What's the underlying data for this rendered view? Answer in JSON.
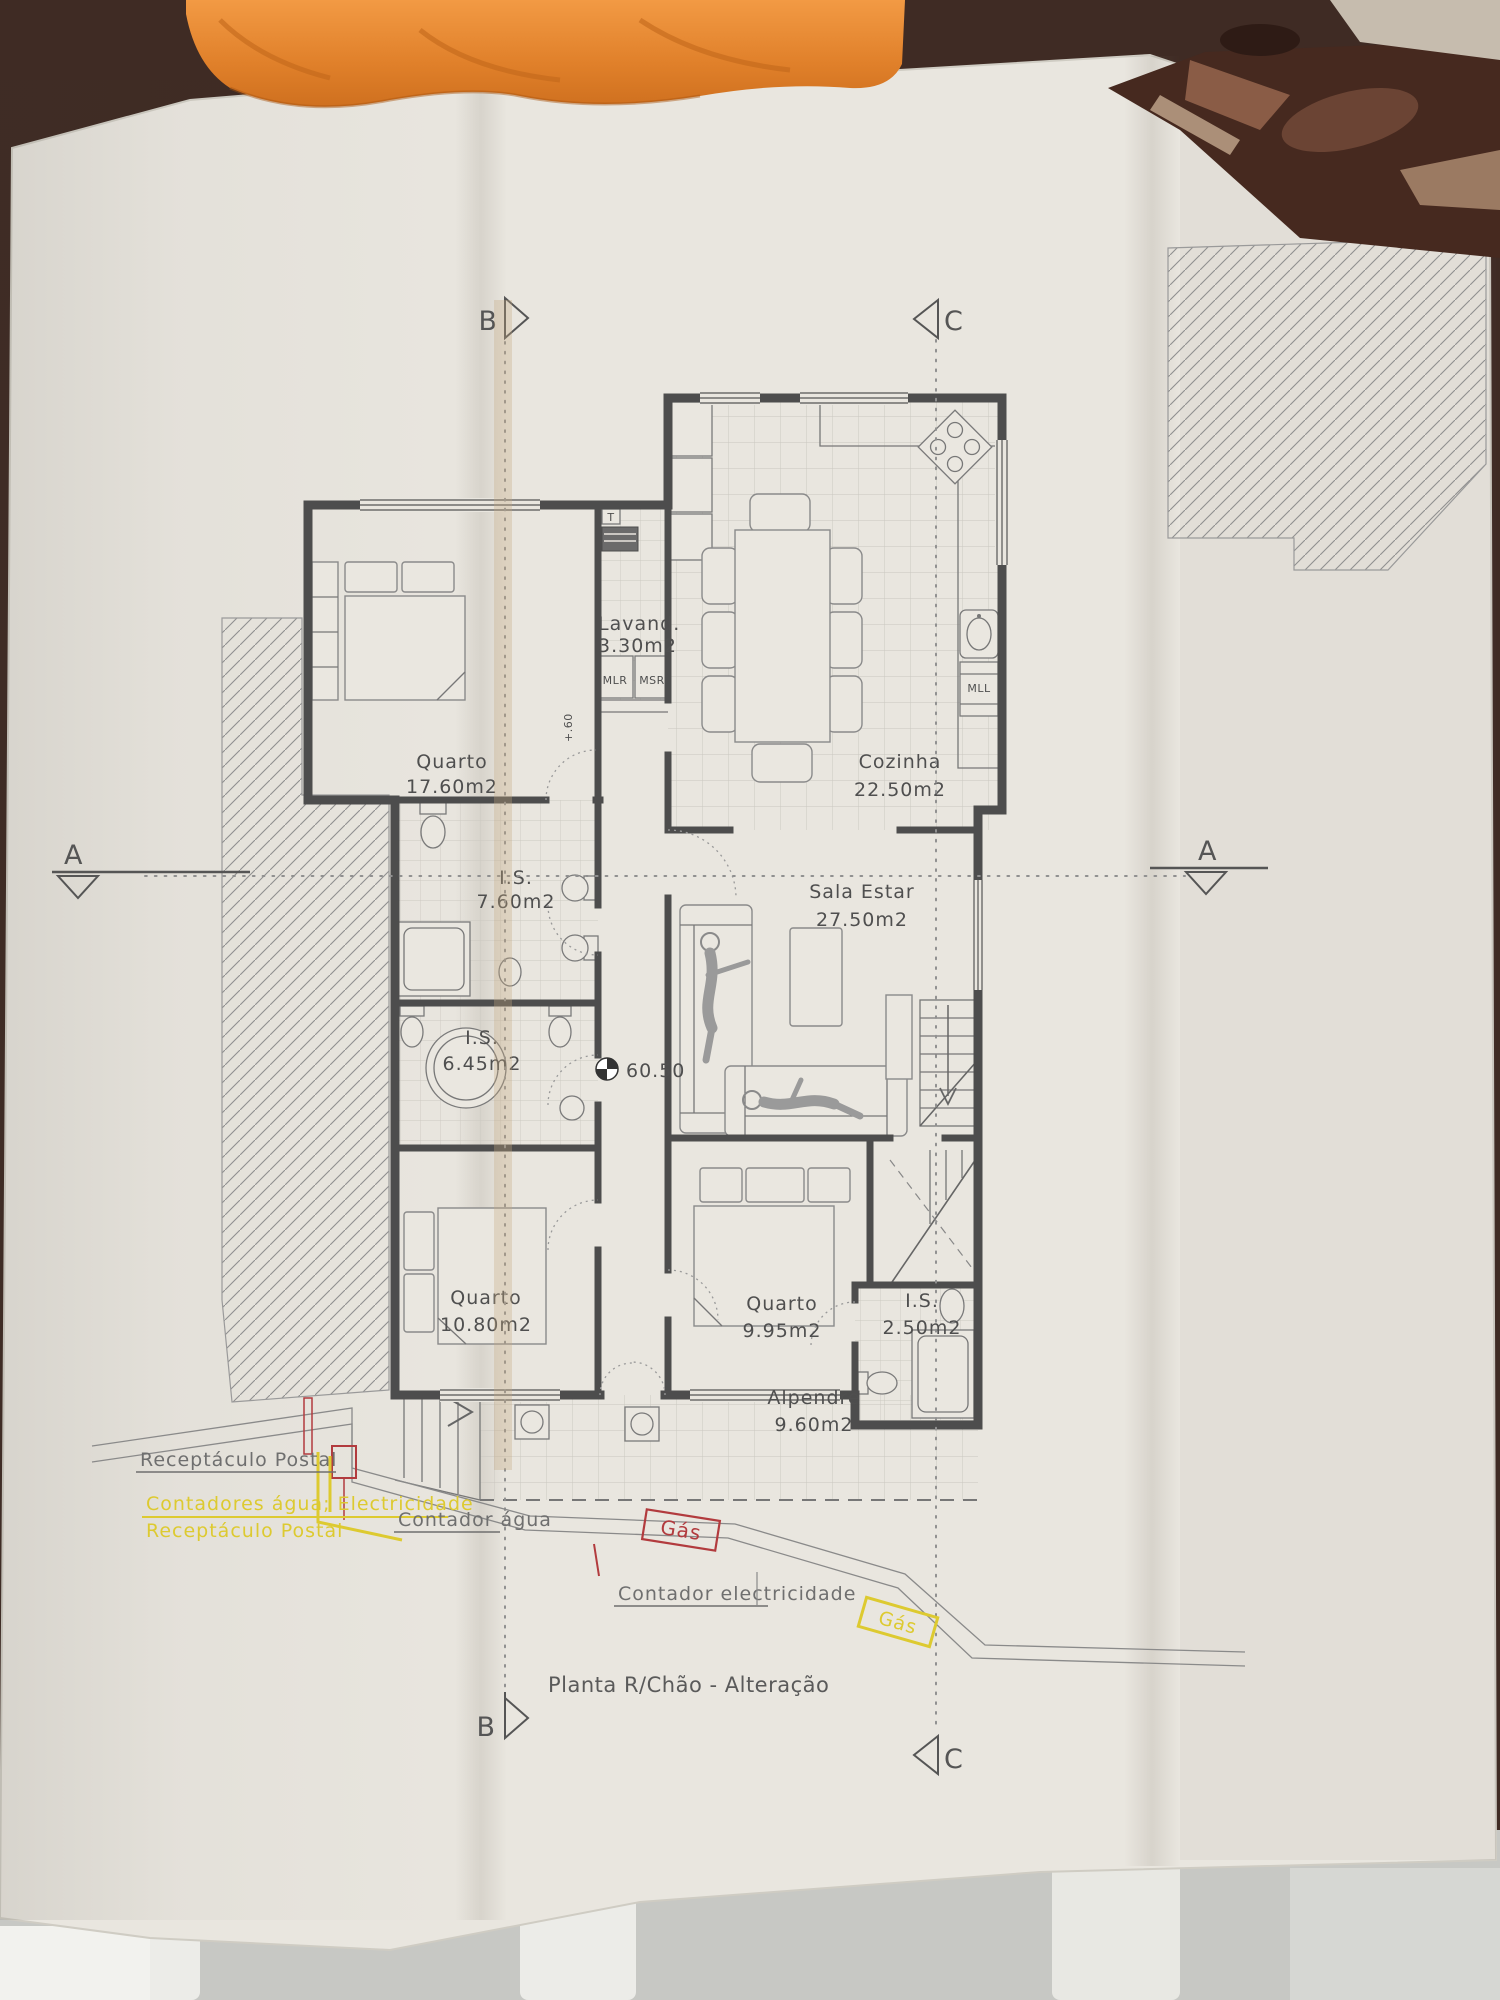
{
  "title": "Planta R/Chão - Alteração",
  "rooms": [
    {
      "name": "Quarto",
      "area": "17.60m2"
    },
    {
      "name": "Lavand.",
      "area": "3.30m2"
    },
    {
      "name": "Cozinha",
      "area": "22.50m2"
    },
    {
      "name": "I.S.",
      "area": "7.60m2"
    },
    {
      "name": "Sala  Estar",
      "area": "27.50m2"
    },
    {
      "name": "I.S.",
      "area": "6.45m2"
    },
    {
      "name": "Quarto",
      "area": "10.80m2"
    },
    {
      "name": "Quarto",
      "area": "9.95m2"
    },
    {
      "name": "I.S.",
      "area": "2.50m2"
    },
    {
      "name": "Alpendre",
      "area": "9.60m2"
    }
  ],
  "markers": {
    "section_a": "A",
    "section_b": "B",
    "section_c": "C",
    "benchmark_level": "60.50",
    "step_level": "+.60"
  },
  "appliances": {
    "water_heater": "T",
    "washing_machine": "MLR",
    "dryer": "MSR",
    "dishwasher": "MLL"
  },
  "annotations": {
    "receptaculo_postal": "Receptáculo Postal",
    "contadores_agua_electricidade": "Contadores água; Electricidade",
    "receptaculo_postal_2": "Receptáculo Postal",
    "contador_agua": "Contador água",
    "contador_electricidade": "Contador electricidade",
    "gas_red": "Gás",
    "gas_yellow": "Gás"
  },
  "colors": {
    "highlight_yellow": "#ddca30",
    "highlight_red": "#b23b3e",
    "ink": "#4f4f4f",
    "paper": "#e9e6df",
    "towel_orange": "#e5883a",
    "table_brown": "#46291f"
  }
}
